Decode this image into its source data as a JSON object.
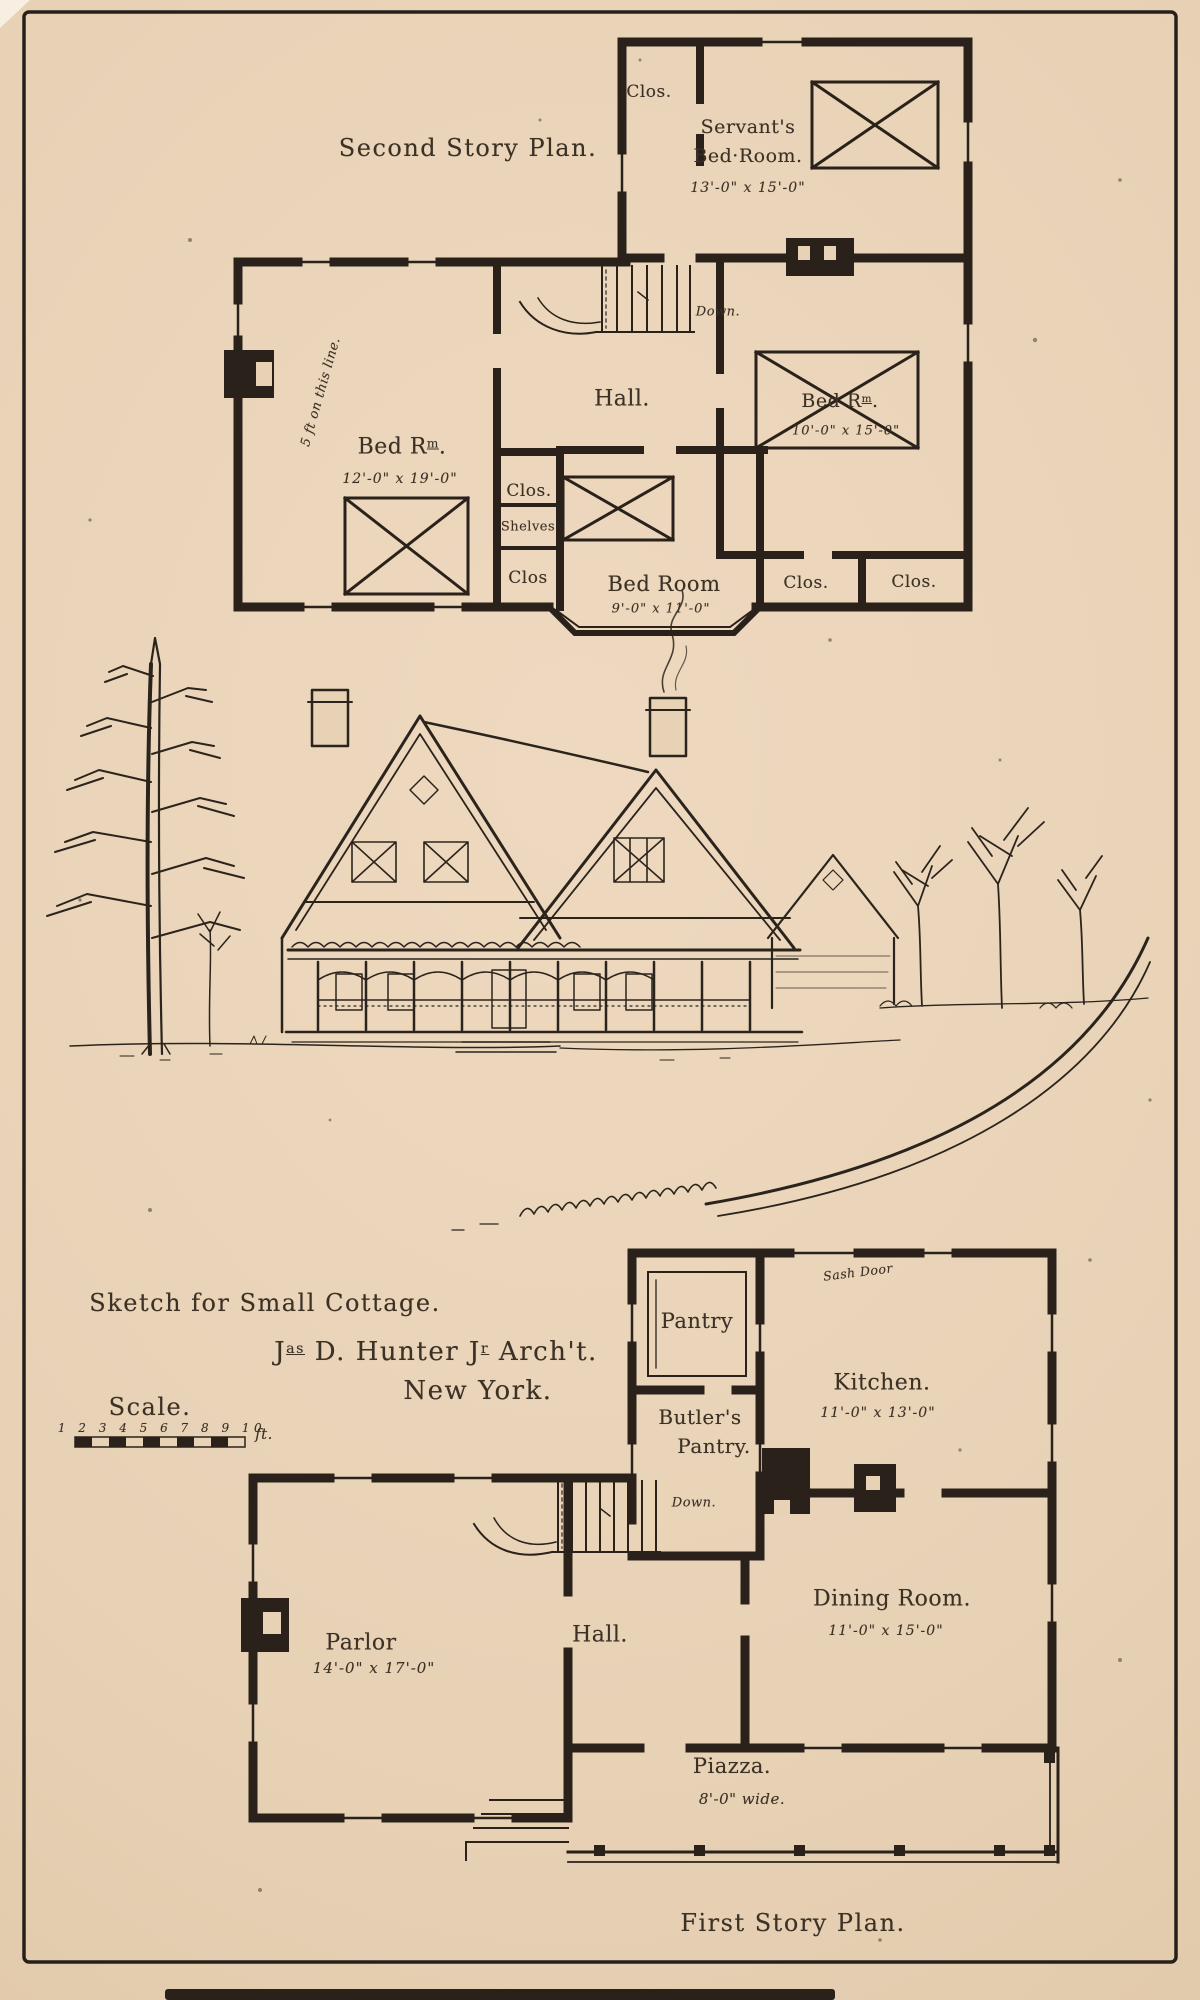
{
  "colors": {
    "paper": "#e8d2b6",
    "ink": "#2a221a",
    "text_ink": "#3c3125"
  },
  "second_story": {
    "title": "Second Story Plan.",
    "clos_top": "Clos.",
    "servants_line1": "Servant's",
    "servants_line2": "Bed·Room.",
    "servants_dims": "13'-0\" x 15'-0\"",
    "bed_rm_parts": {
      "p1": "Bed R",
      "sup": "m",
      "p2": "."
    },
    "bed_left_dims": "12'-0\" x 19'-0\"",
    "hall_label": "Hall.",
    "bed_right_dims": "10'-0\" x 15'-0\"",
    "clos_mid": "Clos.",
    "shelves": "Shelves",
    "clos_left_lower": "Clos",
    "bed_center_label": "Bed Room",
    "bed_center_dims": "9'-0\" x 11'-0\"",
    "clos_bottom_left": "Clos.",
    "clos_bottom_right": "Clos.",
    "down_label": "Down.",
    "roof_note": "5 ft on this line."
  },
  "center": {
    "sketch_title": "Sketch for Small Cottage.",
    "architect_parts": {
      "p1": "J",
      "s1": "as",
      "p2": " D. Hunter J",
      "s2": "r",
      "p3": " Arch't."
    },
    "city": "New York.",
    "scale_label": "Scale.",
    "scale_numbers": "1 2 3 4 5 6 7 8 9 10",
    "scale_unit": "ft."
  },
  "first_story": {
    "title": "First Story Plan.",
    "pantry": "Pantry",
    "sash_door": "Sash Door",
    "kitchen_label": "Kitchen.",
    "kitchen_dims": "11'-0\" x 13'-0\"",
    "butlers_line1": "Butler's",
    "butlers_line2": "Pantry.",
    "down_label": "Down.",
    "dining_label": "Dining Room.",
    "dining_dims": "11'-0\" x 15'-0\"",
    "parlor_label": "Parlor",
    "parlor_dims": "14'-0\" x 17'-0\"",
    "hall_label": "Hall.",
    "piazza_label": "Piazza.",
    "piazza_dims": "8'-0\" wide."
  }
}
